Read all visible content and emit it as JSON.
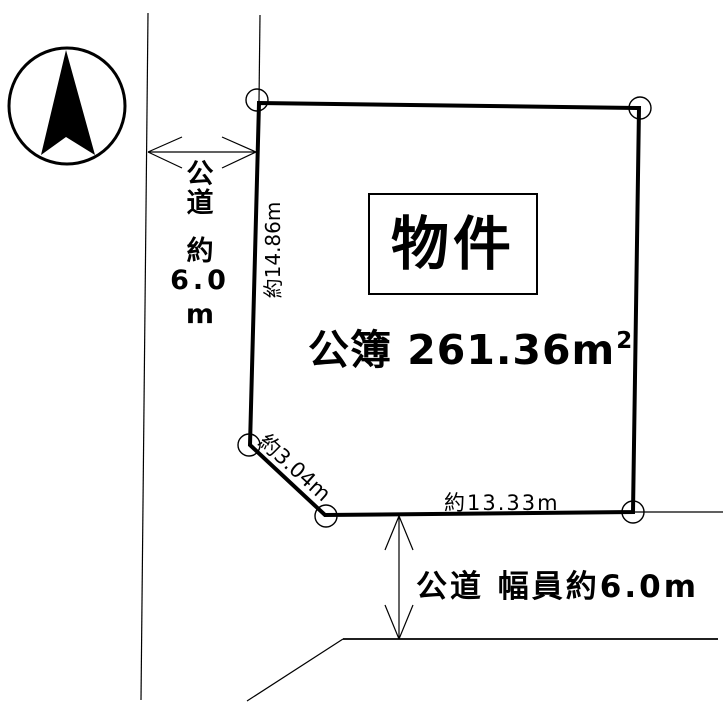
{
  "diagram": {
    "type": "land-plot-site-diagram",
    "background_color": "#ffffff",
    "line_color": "#000000"
  },
  "compass": {
    "icon": "north-arrow-icon"
  },
  "parcel": {
    "label": "物件",
    "registered_area": "公簿 261.36㎡",
    "registered_area_main": "公簿 261.36m",
    "registered_area_sup": "2",
    "dimensions": {
      "west_edge": "約14.86m",
      "corner_cut": "約3.04m",
      "south_edge": "約13.33m"
    }
  },
  "roads": {
    "west": {
      "label": "公道 約6.0m",
      "label_lines": [
        "公",
        "道",
        "約",
        "6.0",
        "m"
      ]
    },
    "south": {
      "label": "公道 幅員約6.0m"
    }
  }
}
